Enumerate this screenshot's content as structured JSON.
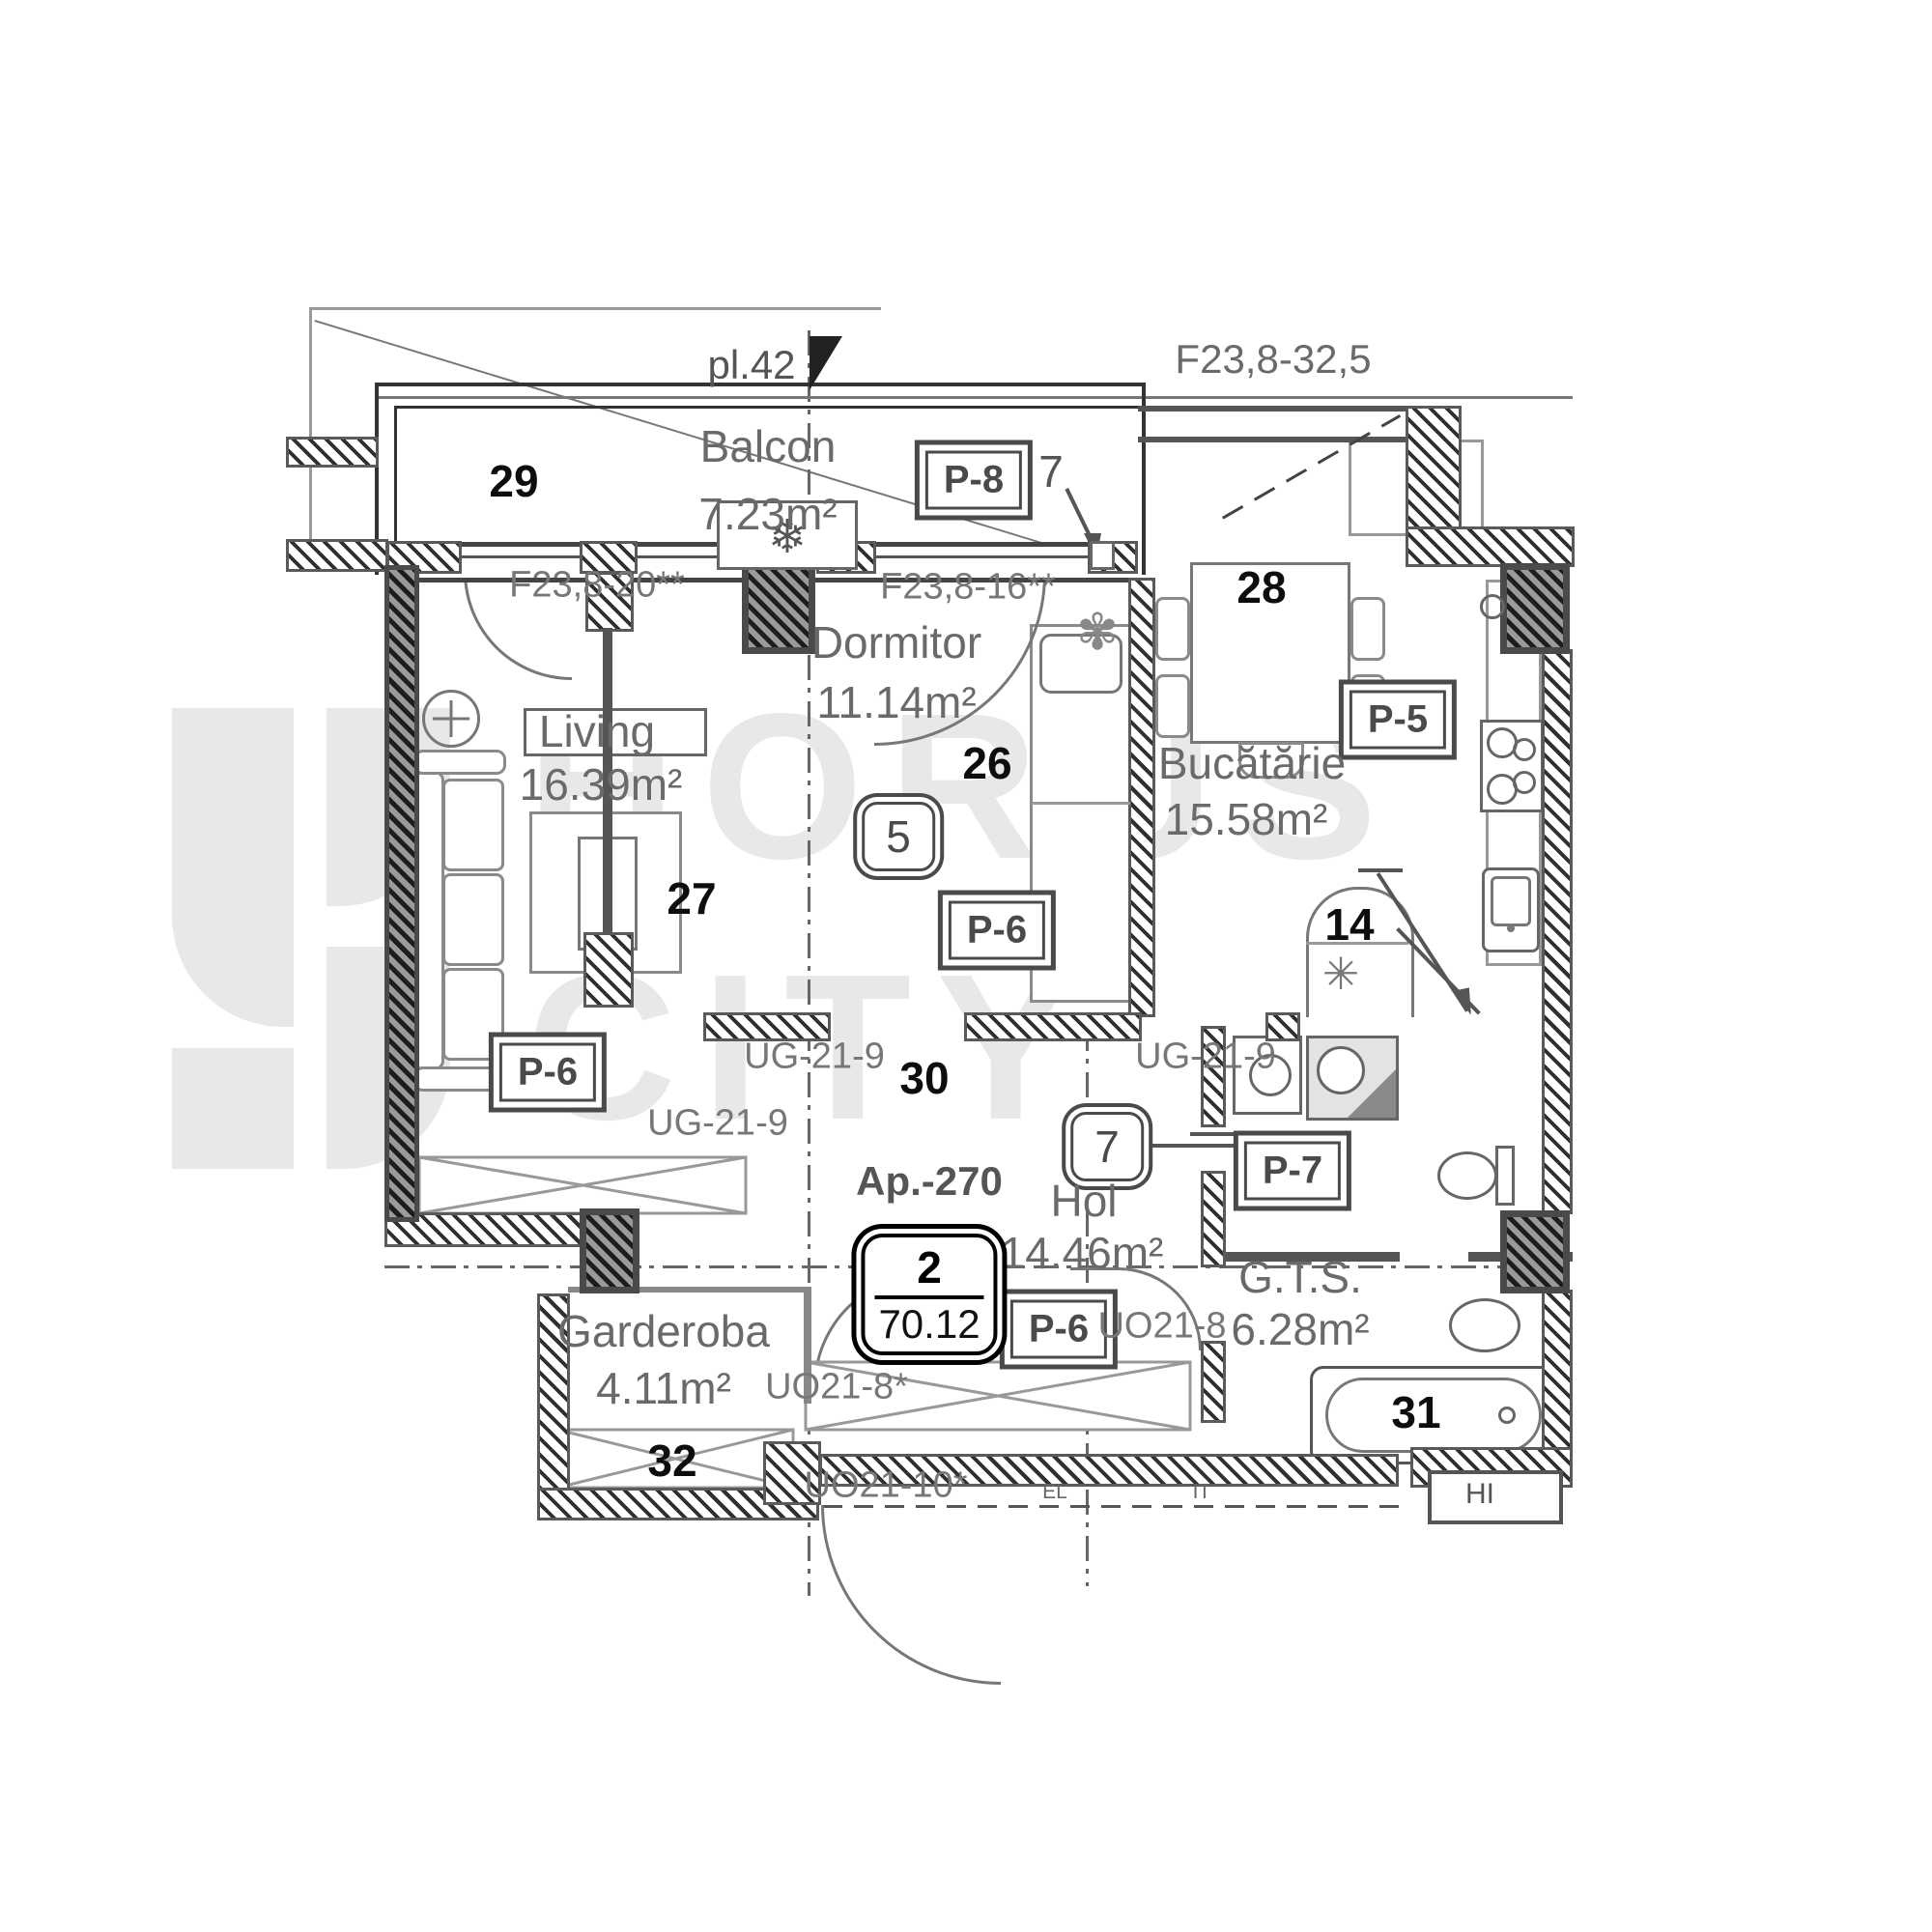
{
  "watermark": {
    "word1": "HORUS",
    "word2": "CITY",
    "color": "#e8e8e8"
  },
  "top": {
    "plan_ref": "pl.42",
    "window_dim": "F23,8-32,5"
  },
  "rooms": {
    "balcon": {
      "name": "Balcon",
      "area": "7.23m²",
      "number": "29"
    },
    "dormitor": {
      "name": "Dormitor",
      "area": "11.14m²",
      "number": "26"
    },
    "living": {
      "name": "Living",
      "area": "16.39m²",
      "number": "27"
    },
    "bucatarie": {
      "name": "Bucătărie",
      "area": "15.58m²",
      "number": "28"
    },
    "hol": {
      "name": "Hol",
      "area": "14.46m²",
      "number": "30"
    },
    "garderoba": {
      "name": "Garderoba",
      "area": "4.11m²",
      "number": "32"
    },
    "gts": {
      "name": "G.T.S.",
      "area": "6.28m²",
      "number": "31"
    }
  },
  "apartment": {
    "ref": "Ap.-270",
    "unit_number": "2",
    "total_area": "70.12"
  },
  "panel_tags": {
    "p8": "P-8",
    "p5": "P-5",
    "p6_dormitor": "P-6",
    "p6_living": "P-6",
    "p6_hol": "P-6",
    "p7": "P-7"
  },
  "door_tags": {
    "d5": "5",
    "d7": "7"
  },
  "window_tags": {
    "w_left": "F23,8-20**",
    "w_mid": "F23,8-16**"
  },
  "opening_tags": {
    "ug_left": "UG-21-9",
    "ug_right": "UG-21-9",
    "ug_lower": "UG-21-9",
    "uo_hol": "UO21-8",
    "uo_garderoba": "UO21-8*",
    "uo_bottom": "UO21-10*"
  },
  "misc": {
    "balcony_item": "7",
    "boiler_bay": "14",
    "el": "EL",
    "it": "IT",
    "hi": "HI"
  }
}
